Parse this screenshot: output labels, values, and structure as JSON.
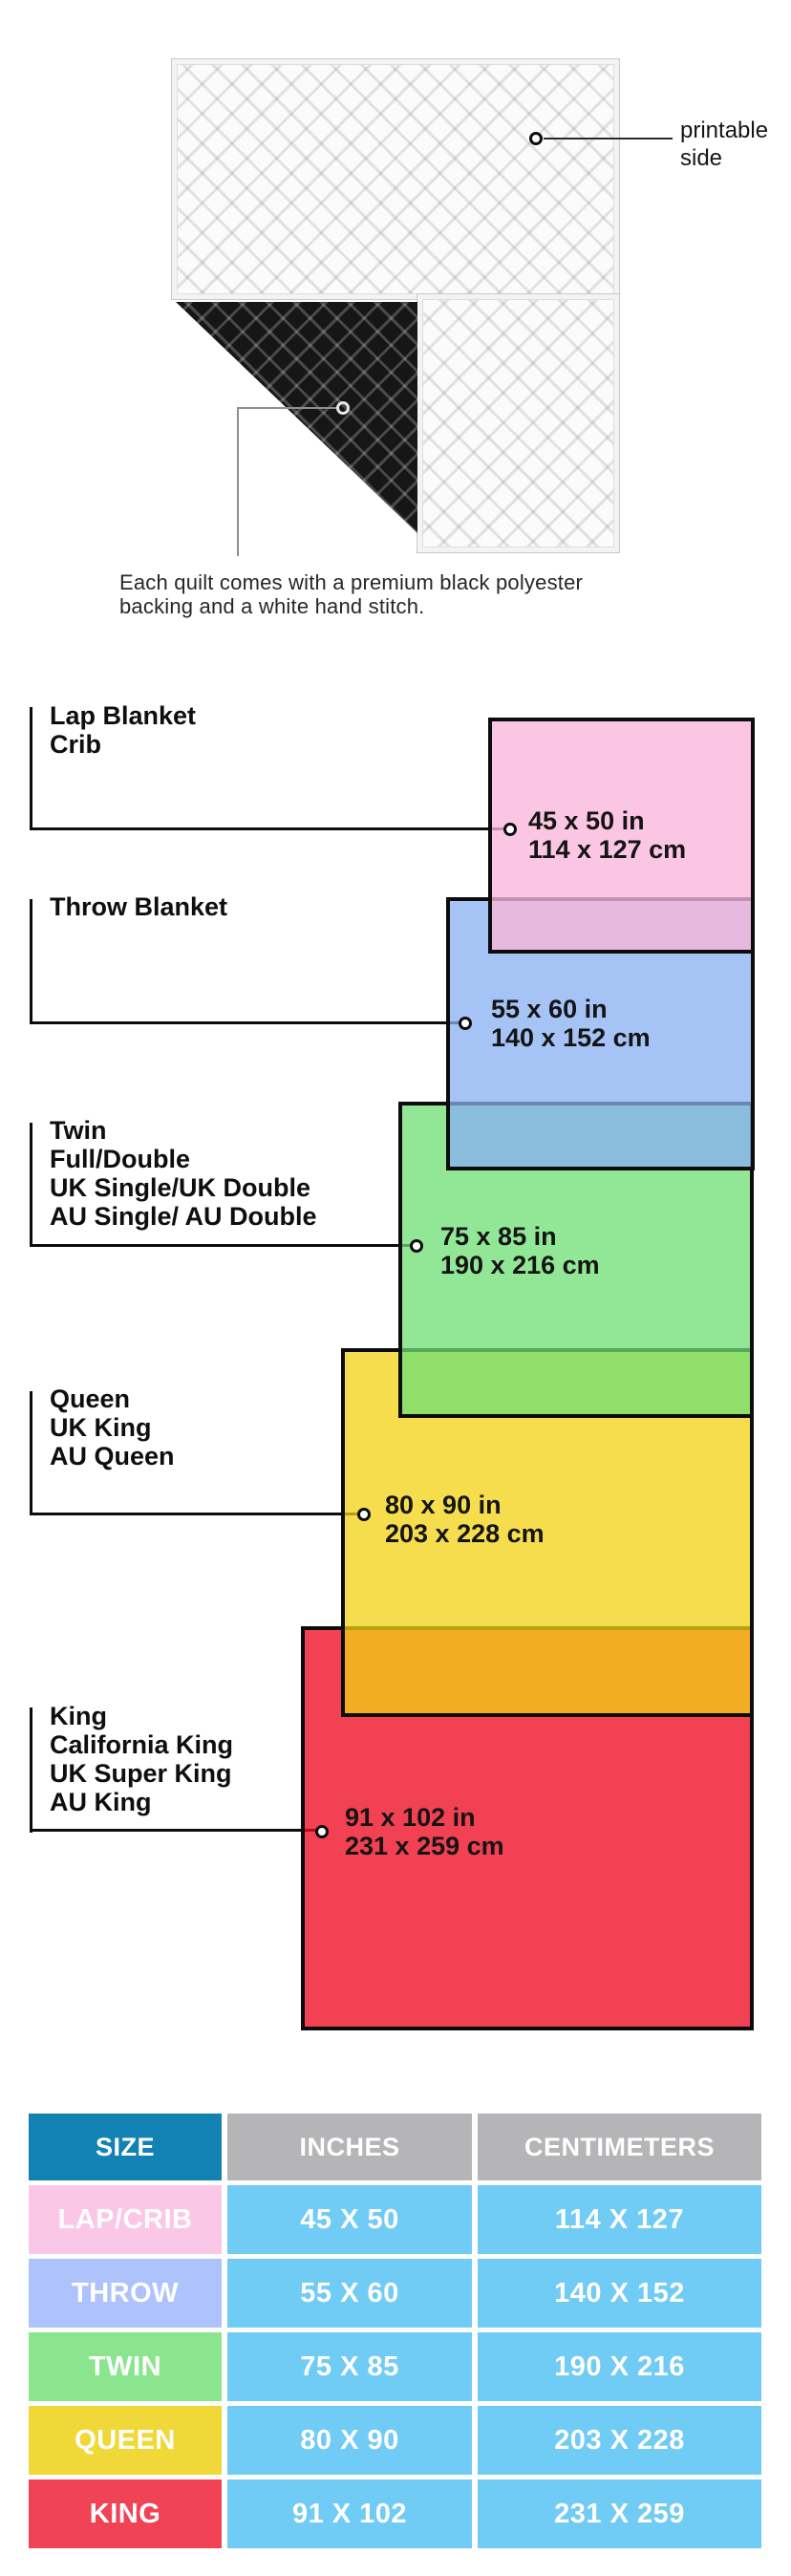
{
  "hero": {
    "printable_label_lines": [
      "printable",
      "side"
    ],
    "caption_lines": [
      "Each quilt comes with a premium black polyester",
      "backing and a white hand stitch."
    ]
  },
  "diagram": {
    "items": [
      {
        "id": "lap",
        "labels": [
          "Lap Blanket",
          "Crib"
        ],
        "inches": "45 x 50 in",
        "cm": "114 x 127 cm",
        "fill": "#FAC8E4"
      },
      {
        "id": "throw",
        "labels": [
          "Throw Blanket"
        ],
        "inches": "55 x 60 in",
        "cm": "140 x 152 cm",
        "fill": "#A5C3F5"
      },
      {
        "id": "twin",
        "labels": [
          "Twin",
          "Full/Double",
          "UK Single/UK Double",
          "AU Single/ AU Double"
        ],
        "inches": "75 x 85 in",
        "cm": "190 x 216 cm",
        "fill": "#92E797"
      },
      {
        "id": "queen",
        "labels": [
          "Queen",
          "UK King",
          "AU Queen"
        ],
        "inches": "80 x 90 in",
        "cm": "203 x 228 cm",
        "fill": "#F5DD4D"
      },
      {
        "id": "king",
        "labels": [
          "King",
          "California King",
          "UK Super King",
          "AU King"
        ],
        "inches": "91 x 102 in",
        "cm": "231 x 259 cm",
        "fill": "#F4495B"
      }
    ],
    "overlap_colors": {
      "lap_throw": "#DDB6E8",
      "throw_twin": "#7FB9D8",
      "twin_queen": "#9EDC55",
      "queen_king": "#F2AC2E"
    }
  },
  "table": {
    "headers": [
      "SIZE",
      "INCHES",
      "CENTIMETERS"
    ],
    "header_size_bg": "#1282B4",
    "header_metric_bg": "#B5B5B8",
    "data_cell_bg": "#70CBF5",
    "rows": [
      {
        "size": "LAP/CRIB",
        "inches": "45 X 50",
        "cm": "114 X 127",
        "size_bg": "#FBC7E6"
      },
      {
        "size": "THROW",
        "inches": "55 X 60",
        "cm": "140 X 152",
        "size_bg": "#AEC3FB"
      },
      {
        "size": "TWIN",
        "inches": "75 X 85",
        "cm": "190 X 216",
        "size_bg": "#8BE58F"
      },
      {
        "size": "QUEEN",
        "inches": "80 X 90",
        "cm": "203 X 228",
        "size_bg": "#F0D838"
      },
      {
        "size": "KING",
        "inches": "91 X 102",
        "cm": "231 X 259",
        "size_bg": "#F04356"
      }
    ]
  }
}
